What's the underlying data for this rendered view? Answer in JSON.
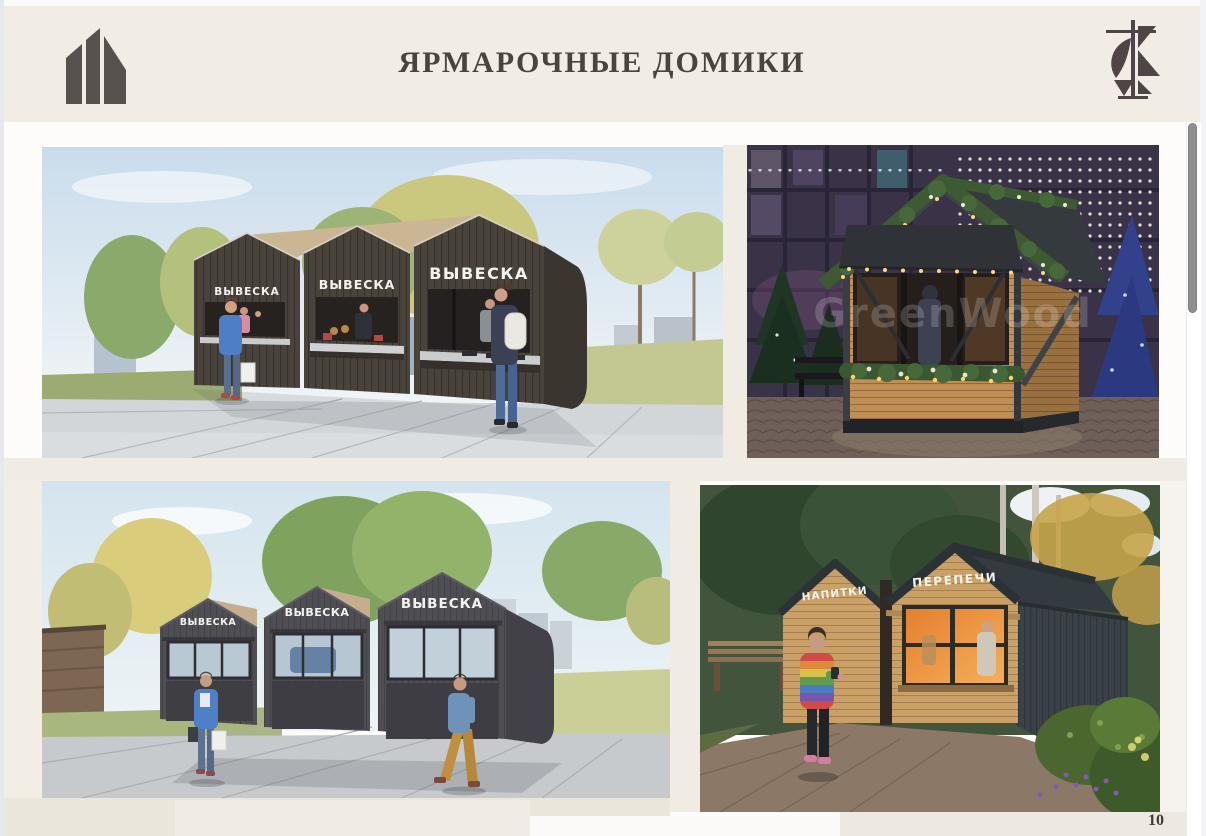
{
  "header": {
    "title": "ЯРМАРОЧНЫЕ ДОМИКИ",
    "left_logo": "building-monogram",
    "right_logo": "architecture-emblem"
  },
  "footer": {
    "page_number": "10"
  },
  "scrollbar": {
    "visible": true
  },
  "colors": {
    "header_bg": "#f1ede5",
    "title_text": "#4a4440",
    "slide_bg": "#fdfcfa",
    "beige_band": "#f0ebe3",
    "scrollbar_thumb": "#8f8f8f"
  },
  "figures": {
    "top_left": {
      "signs": [
        "ВЫВЕСКА",
        "ВЫВЕСКА",
        "ВЫВЕСКА"
      ]
    },
    "top_right": {
      "watermark": "GreenWood"
    },
    "bottom_left": {
      "signs": [
        "ВЫВЕСКА",
        "ВЫВЕСКА",
        "ВЫВЕСКА"
      ]
    },
    "bottom_right": {
      "signs": [
        "НАПИТКИ",
        "ПЕРЕПЕЧИ"
      ]
    }
  }
}
